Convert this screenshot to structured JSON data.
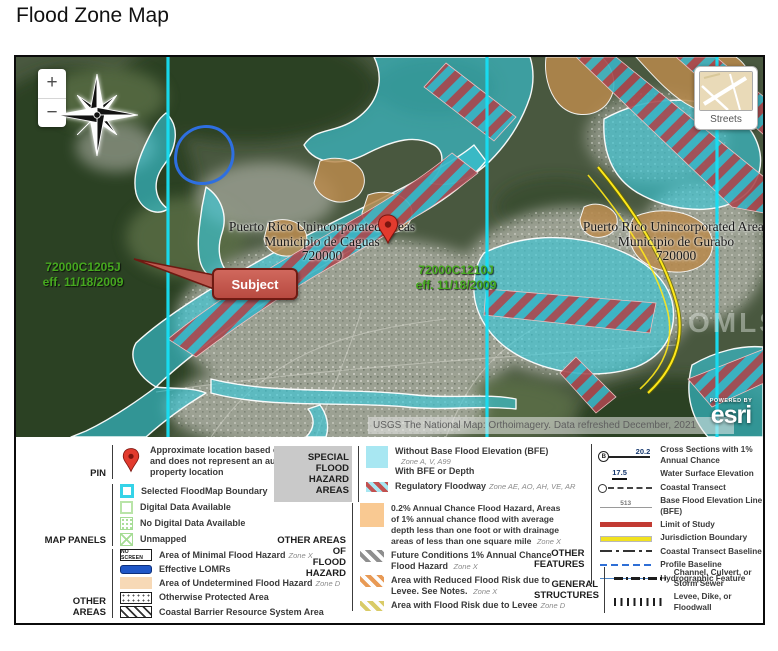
{
  "page": {
    "title": "Flood Zone Map"
  },
  "map": {
    "controls": {
      "zoom_in": "+",
      "zoom_out": "−",
      "basemap_label": "Streets"
    },
    "labels": {
      "caguas": {
        "line1": "Puerto Rico Unincorporated Areas",
        "line2": "Municipio de Caguas",
        "line3": "720000"
      },
      "gurabo": {
        "line1": "Puerto Rico Unincorporated Areas",
        "line2": "Municipio de Gurabo",
        "line3": "720000"
      },
      "panel_left": {
        "line1": "72000C1205J",
        "line2": "eff. 11/18/2009"
      },
      "panel_right": {
        "line1": "72000C1210J",
        "line2": "eff. 11/18/2009"
      },
      "subject": "Subject",
      "watermark": "OMLS"
    },
    "attribution": "USGS The National Map: Orthoimagery. Data refreshed December, 2021",
    "powered_by": "POWERED BY",
    "esri": "esri"
  },
  "legend": {
    "pin": {
      "label": "PIN",
      "text": "Approximate location based on user input and does not represent an authoritative property location"
    },
    "map_panels": {
      "label": "MAP PANELS",
      "items": [
        {
          "text": "Selected FloodMap Boundary"
        },
        {
          "text": "Digital Data Available"
        },
        {
          "text": "No Digital Data Available"
        },
        {
          "text": "Unmapped"
        }
      ]
    },
    "other_areas": {
      "label": "OTHER AREAS",
      "items": [
        {
          "swatch_text": "NO SCREEN",
          "text": "Area of Minimal Flood Hazard",
          "zone": "Zone X"
        },
        {
          "text": "Effective LOMRs",
          "zone": ""
        },
        {
          "text": "Area of Undetermined Flood Hazard",
          "zone": "Zone D"
        },
        {
          "text": "Otherwise Protected Area",
          "zone": ""
        },
        {
          "text": "Coastal Barrier Resource System Area",
          "zone": ""
        }
      ]
    },
    "sfha": {
      "label_line1": "SPECIAL FLOOD",
      "label_line2": "HAZARD AREAS",
      "row1_text": "Without Base Flood Elevation (BFE)",
      "row1_zone": "Zone A, V, A99",
      "row2_text": "With BFE or Depth",
      "row3_text": "Regulatory Floodway",
      "row3_zone": "Zone AE, AO, AH, VE, AR"
    },
    "other_flood": {
      "label_line1": "OTHER AREAS OF",
      "label_line2": "FLOOD HAZARD",
      "items": [
        {
          "text": "0.2% Annual Chance Flood Hazard, Areas of 1% annual chance flood with average depth less than one foot or with drainage areas of less than one square mile",
          "zone": "Zone X"
        },
        {
          "text": "Future Conditions 1% Annual Chance Flood Hazard",
          "zone": "Zone X"
        },
        {
          "text": "Area with Reduced Flood Risk due to Levee. See Notes.",
          "zone": "Zone X"
        },
        {
          "text": "Area with Flood Risk due to Levee",
          "zone": "Zone D"
        }
      ]
    },
    "other_features": {
      "label_line1": "OTHER",
      "label_line2": "FEATURES",
      "cross_section_letter": "B",
      "cross_section_value": "20.2",
      "wse_value": "17.5",
      "bfe_value": "513",
      "items": [
        {
          "text": "Cross Sections with 1% Annual Chance"
        },
        {
          "text": "Water Surface Elevation"
        },
        {
          "text": "Coastal Transect"
        },
        {
          "text": "Base Flood Elevation Line (BFE)"
        },
        {
          "text": "Limit of Study"
        },
        {
          "text": "Jurisdiction Boundary"
        },
        {
          "text": "Coastal Transect Baseline"
        },
        {
          "text": "Profile Baseline"
        },
        {
          "text": "Hydrographic Feature"
        }
      ]
    },
    "general_structures": {
      "label_line1": "GENERAL",
      "label_line2": "STRUCTURES",
      "items": [
        {
          "text": "Channel, Culvert, or Storm Sewer"
        },
        {
          "text": "Levee, Dike, or Floodwall"
        }
      ]
    }
  },
  "colors": {
    "flood_cyan": "#37c9dc",
    "floodway_red": "#a9474e",
    "zone_d_tan": "#f7d9b6",
    "chance_orange": "#f9c992",
    "panel_line_cyan": "#17dff4",
    "pin_red": "#e23b2e",
    "subject_red": "#b84a41",
    "panel_text_green": "#46a81f",
    "jurisdiction_yellow": "#ffe81a",
    "lomr_blue": "#2e6fe0",
    "limit_red": "#c23b33",
    "profile_blue": "#2f6fd6"
  }
}
